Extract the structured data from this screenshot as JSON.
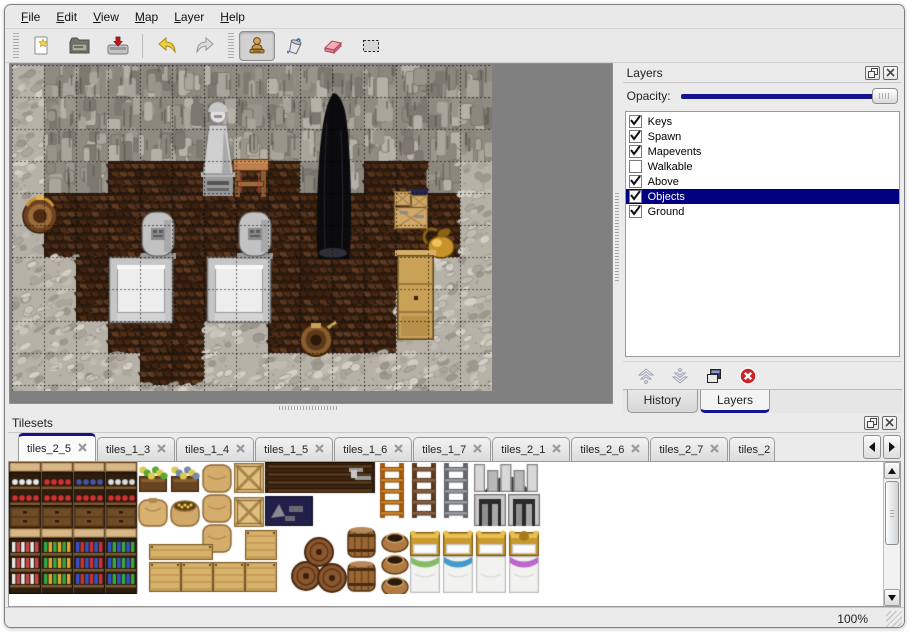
{
  "colors": {
    "accent_navy": "#14148c",
    "selection_navy": "#000080",
    "panel_bg": "#ebebeb",
    "map_viewport_bg": "#808080"
  },
  "menu": {
    "items": [
      {
        "label": "File"
      },
      {
        "label": "Edit"
      },
      {
        "label": "View"
      },
      {
        "label": "Map"
      },
      {
        "label": "Layer"
      },
      {
        "label": "Help"
      }
    ]
  },
  "toolbar": {
    "buttons": [
      {
        "icon": "new",
        "name": "new-file-button",
        "selected": false
      },
      {
        "icon": "open",
        "name": "open-file-button",
        "selected": false
      },
      {
        "icon": "save",
        "name": "save-file-button",
        "selected": false
      },
      {
        "icon": "sep"
      },
      {
        "icon": "undo",
        "name": "undo-button",
        "selected": false
      },
      {
        "icon": "redo",
        "name": "redo-button",
        "selected": false
      },
      {
        "icon": "handle"
      },
      {
        "icon": "stamp",
        "name": "stamp-tool-button",
        "selected": true
      },
      {
        "icon": "fill",
        "name": "fill-tool-button",
        "selected": false
      },
      {
        "icon": "eraser",
        "name": "eraser-tool-button",
        "selected": false
      },
      {
        "icon": "select",
        "name": "select-tool-button",
        "selected": false
      }
    ]
  },
  "layers_panel": {
    "title": "Layers",
    "opacity_label": "Opacity:",
    "opacity_percent": 100,
    "layers": [
      {
        "name": "Keys",
        "checked": true,
        "selected": false
      },
      {
        "name": "Spawn",
        "checked": true,
        "selected": false
      },
      {
        "name": "Mapevents",
        "checked": true,
        "selected": false
      },
      {
        "name": "Walkable",
        "checked": false,
        "selected": false
      },
      {
        "name": "Above",
        "checked": true,
        "selected": false
      },
      {
        "name": "Objects",
        "checked": true,
        "selected": true
      },
      {
        "name": "Ground",
        "checked": true,
        "selected": false
      }
    ],
    "bottom_tabs": [
      {
        "label": "History",
        "active": false
      },
      {
        "label": "Layers",
        "active": true
      }
    ]
  },
  "tilesets_panel": {
    "title": "Tilesets",
    "tabs": [
      {
        "label": "tiles_2_5",
        "active": true
      },
      {
        "label": "tiles_1_3",
        "active": false
      },
      {
        "label": "tiles_1_4",
        "active": false
      },
      {
        "label": "tiles_1_5",
        "active": false
      },
      {
        "label": "tiles_1_6",
        "active": false
      },
      {
        "label": "tiles_1_7",
        "active": false
      },
      {
        "label": "tiles_2_1",
        "active": false
      },
      {
        "label": "tiles_2_6",
        "active": false
      },
      {
        "label": "tiles_2_7",
        "active": false
      },
      {
        "label": "tiles_2",
        "active": false,
        "truncated": true
      }
    ]
  },
  "status_bar": {
    "zoom_level": "100%"
  },
  "map_view": {
    "grid_size": 32,
    "tiles_w": 15,
    "tiles_h": 11,
    "floor_rects": [
      [
        3,
        3,
        6,
        1
      ],
      [
        11,
        3,
        2,
        1
      ],
      [
        1,
        4,
        13,
        1
      ],
      [
        1,
        5,
        13,
        1
      ],
      [
        2,
        6,
        11,
        1
      ],
      [
        2,
        7,
        10,
        1
      ],
      [
        3,
        8,
        3,
        1
      ],
      [
        8,
        8,
        4,
        1
      ],
      [
        4,
        9,
        2,
        1
      ]
    ],
    "objects": [
      {
        "type": "platform",
        "x": 97,
        "y": 192
      },
      {
        "type": "platform",
        "x": 195,
        "y": 192
      },
      {
        "type": "gravestone",
        "x": 130,
        "y": 147
      },
      {
        "type": "gravestone",
        "x": 227,
        "y": 147
      },
      {
        "type": "statue",
        "x": 188,
        "y": 30
      },
      {
        "type": "desk",
        "x": 221,
        "y": 94
      },
      {
        "type": "dark-figure",
        "x": 303,
        "y": 28
      },
      {
        "type": "basket",
        "x": 8,
        "y": 128
      },
      {
        "type": "crates",
        "x": 382,
        "y": 124
      },
      {
        "type": "gold-pot",
        "x": 412,
        "y": 158
      },
      {
        "type": "cabinet",
        "x": 385,
        "y": 187
      },
      {
        "type": "tub",
        "x": 287,
        "y": 256
      }
    ]
  },
  "tileset_content": {
    "groups": [
      {
        "type": "shelfA",
        "x": 0,
        "y": 0,
        "items": [
          "#e8e8e8",
          "#cc3333"
        ]
      },
      {
        "type": "shelfA",
        "x": 32,
        "y": 0,
        "items": [
          "#cc3333",
          "#cc3333"
        ]
      },
      {
        "type": "shelfA",
        "x": 64,
        "y": 0,
        "items": [
          "#48549c",
          "#cc3333"
        ]
      },
      {
        "type": "shelfA",
        "x": 96,
        "y": 0,
        "items": [
          "#dcdcdc",
          "#cc3333"
        ]
      },
      {
        "type": "shelfB",
        "x": 0,
        "y": 66,
        "items": [
          "#cc4444",
          "#e8e8e8"
        ]
      },
      {
        "type": "shelfB",
        "x": 32,
        "y": 66,
        "items": [
          "#dcaa33",
          "#33aa44"
        ]
      },
      {
        "type": "shelfB",
        "x": 64,
        "y": 66,
        "items": [
          "#cc3333",
          "#3355cc"
        ]
      },
      {
        "type": "shelfB",
        "x": 96,
        "y": 66,
        "items": [
          "#33aa44",
          "#3355cc"
        ]
      },
      {
        "type": "planter",
        "x": 128,
        "y": 0,
        "color": "#5aa833"
      },
      {
        "type": "planter",
        "x": 160,
        "y": 0,
        "color": "#7888aa"
      },
      {
        "type": "sack",
        "x": 128,
        "y": 34
      },
      {
        "type": "sack-open",
        "x": 160,
        "y": 34
      },
      {
        "type": "sack-stack",
        "x": 192,
        "y": 0
      },
      {
        "type": "crateX",
        "x": 224,
        "y": 0
      },
      {
        "type": "crateX",
        "x": 224,
        "y": 34
      },
      {
        "type": "slat-chest",
        "x": 256,
        "y": 0,
        "w": 110
      },
      {
        "type": "navy-junk",
        "x": 256,
        "y": 34,
        "w": 48
      },
      {
        "type": "ladder",
        "x": 369,
        "y": 0,
        "rail": "#a85c10",
        "rung": "#d08428"
      },
      {
        "type": "ladder",
        "x": 401,
        "y": 0,
        "rail": "#5a3a20",
        "rung": "#8a6240"
      },
      {
        "type": "ladder",
        "x": 433,
        "y": 0,
        "rail": "#65686f",
        "rung": "#9a9da4"
      },
      {
        "type": "arch-top",
        "x": 465,
        "y": 0
      },
      {
        "type": "arch-door",
        "x": 465,
        "y": 32
      },
      {
        "type": "arch-door",
        "x": 499,
        "y": 32
      },
      {
        "type": "crate-plank",
        "x": 140,
        "y": 82,
        "w": 64,
        "h": 16
      },
      {
        "type": "crate-plank",
        "x": 236,
        "y": 68,
        "w": 32,
        "h": 30
      },
      {
        "type": "crate-plank",
        "x": 140,
        "y": 100,
        "w": 32,
        "h": 30
      },
      {
        "type": "crate-plank",
        "x": 172,
        "y": 100,
        "w": 32,
        "h": 30
      },
      {
        "type": "crate-plank",
        "x": 204,
        "y": 100,
        "w": 32,
        "h": 30
      },
      {
        "type": "crate-plank",
        "x": 236,
        "y": 100,
        "w": 32,
        "h": 30
      },
      {
        "type": "barrel-pile",
        "x": 283,
        "y": 64
      },
      {
        "type": "barrel-up",
        "x": 337,
        "y": 64
      },
      {
        "type": "barrel-up",
        "x": 337,
        "y": 98
      },
      {
        "type": "pot-stack",
        "x": 371,
        "y": 64
      },
      {
        "type": "bed",
        "x": 401,
        "trim": "#88bb66"
      },
      {
        "type": "bed",
        "x": 434,
        "trim": "#4499cc"
      },
      {
        "type": "bed",
        "x": 467,
        "trim": null
      },
      {
        "type": "bed",
        "x": 500,
        "trim": "#bb66cc",
        "ornate": true
      }
    ]
  }
}
